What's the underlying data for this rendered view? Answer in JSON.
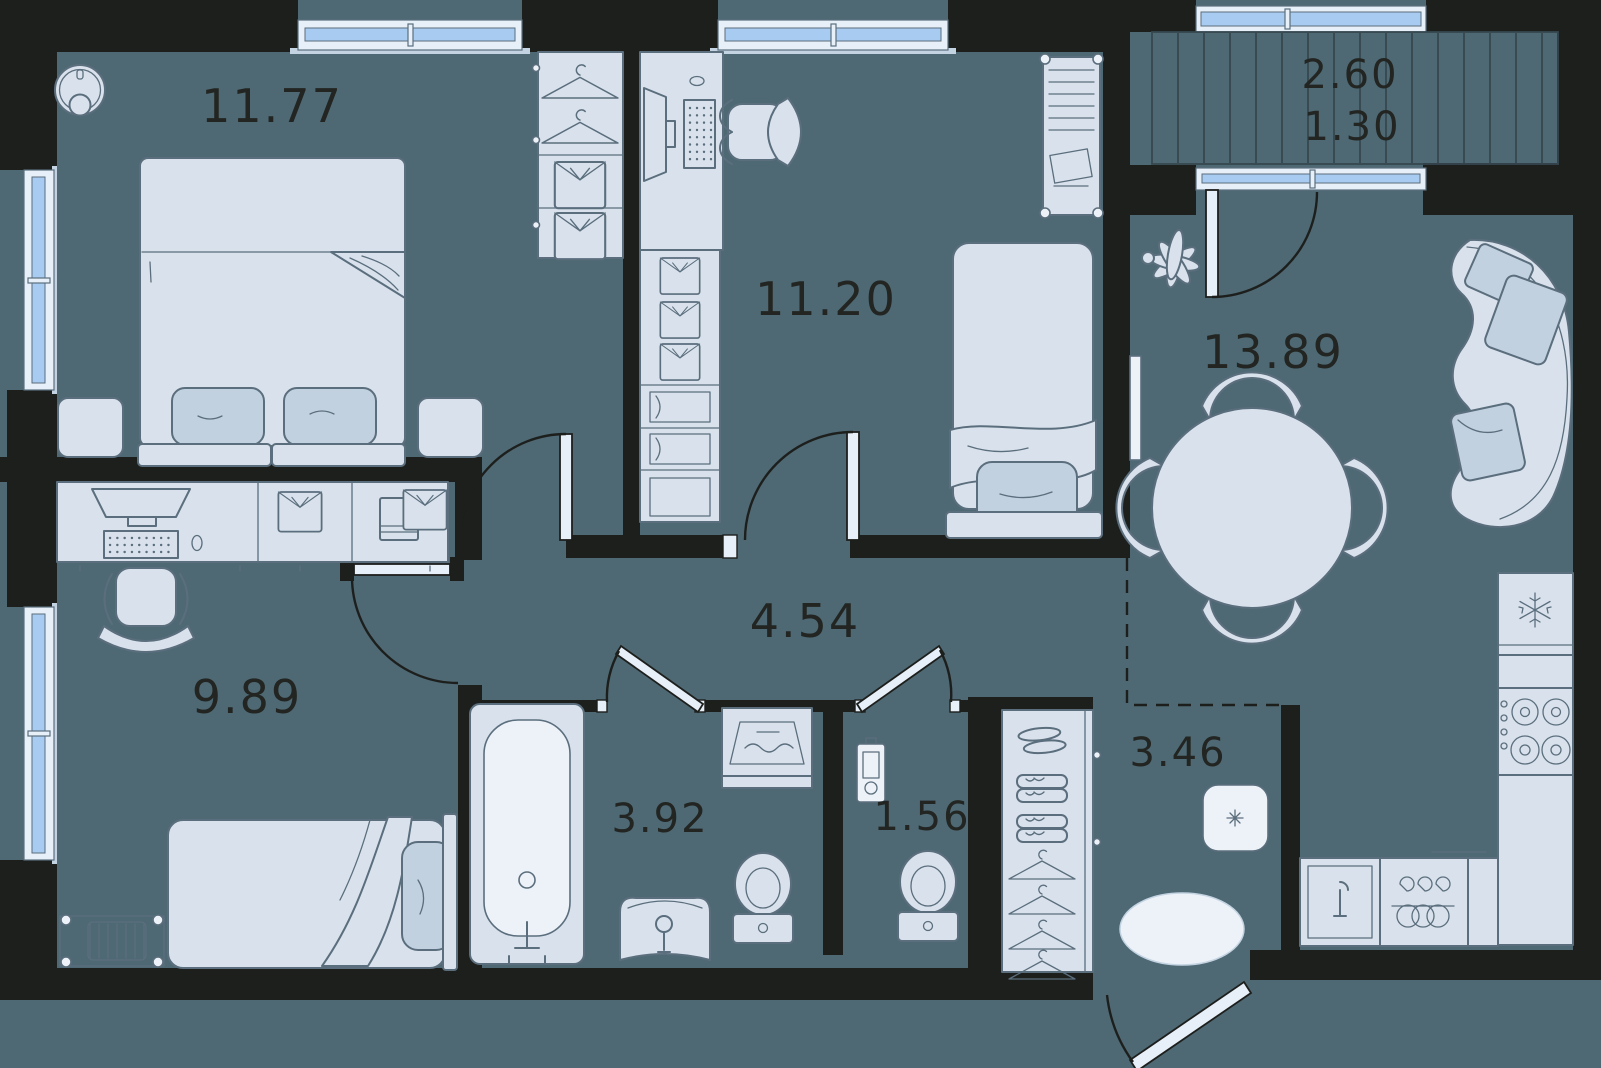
{
  "meta": {
    "kind": "apartment-floor-plan"
  },
  "rooms": {
    "bedroom_main": {
      "area": "11.77"
    },
    "bedroom_second": {
      "area": "11.20"
    },
    "living_kitchen": {
      "area": "13.89"
    },
    "bedroom_small": {
      "area": "9.89"
    },
    "hallway": {
      "area": "4.54"
    },
    "bathroom": {
      "area": "3.92"
    },
    "wc": {
      "area": "1.56"
    },
    "entry_hall": {
      "area": "3.46"
    },
    "balcony": {
      "area_total": "2.60",
      "area_counted": "1.30"
    }
  },
  "colors": {
    "background": "#4e6974",
    "wall": "#1d1f1d",
    "furniture": "#d9e2ec",
    "furniture_dark": "#c2d1e0",
    "outline": "#5b6e7d",
    "white": "#edf2f8",
    "glass": "#a8ccf1",
    "frame": "#e7eff8",
    "sill": "#c3d3e1",
    "hatch": "#36474f",
    "label": "#222521"
  },
  "icons": {
    "robot-vacuum-icon": "circle-with-bumper",
    "hanger-icon": "clothes-hanger",
    "shirt-icon": "folded-shirt",
    "snowflake-icon": "fridge-freezer",
    "burner-icon": "stove-ring",
    "wave-icon": "washing-machine",
    "sparkle-icon": "pouf-cross"
  }
}
